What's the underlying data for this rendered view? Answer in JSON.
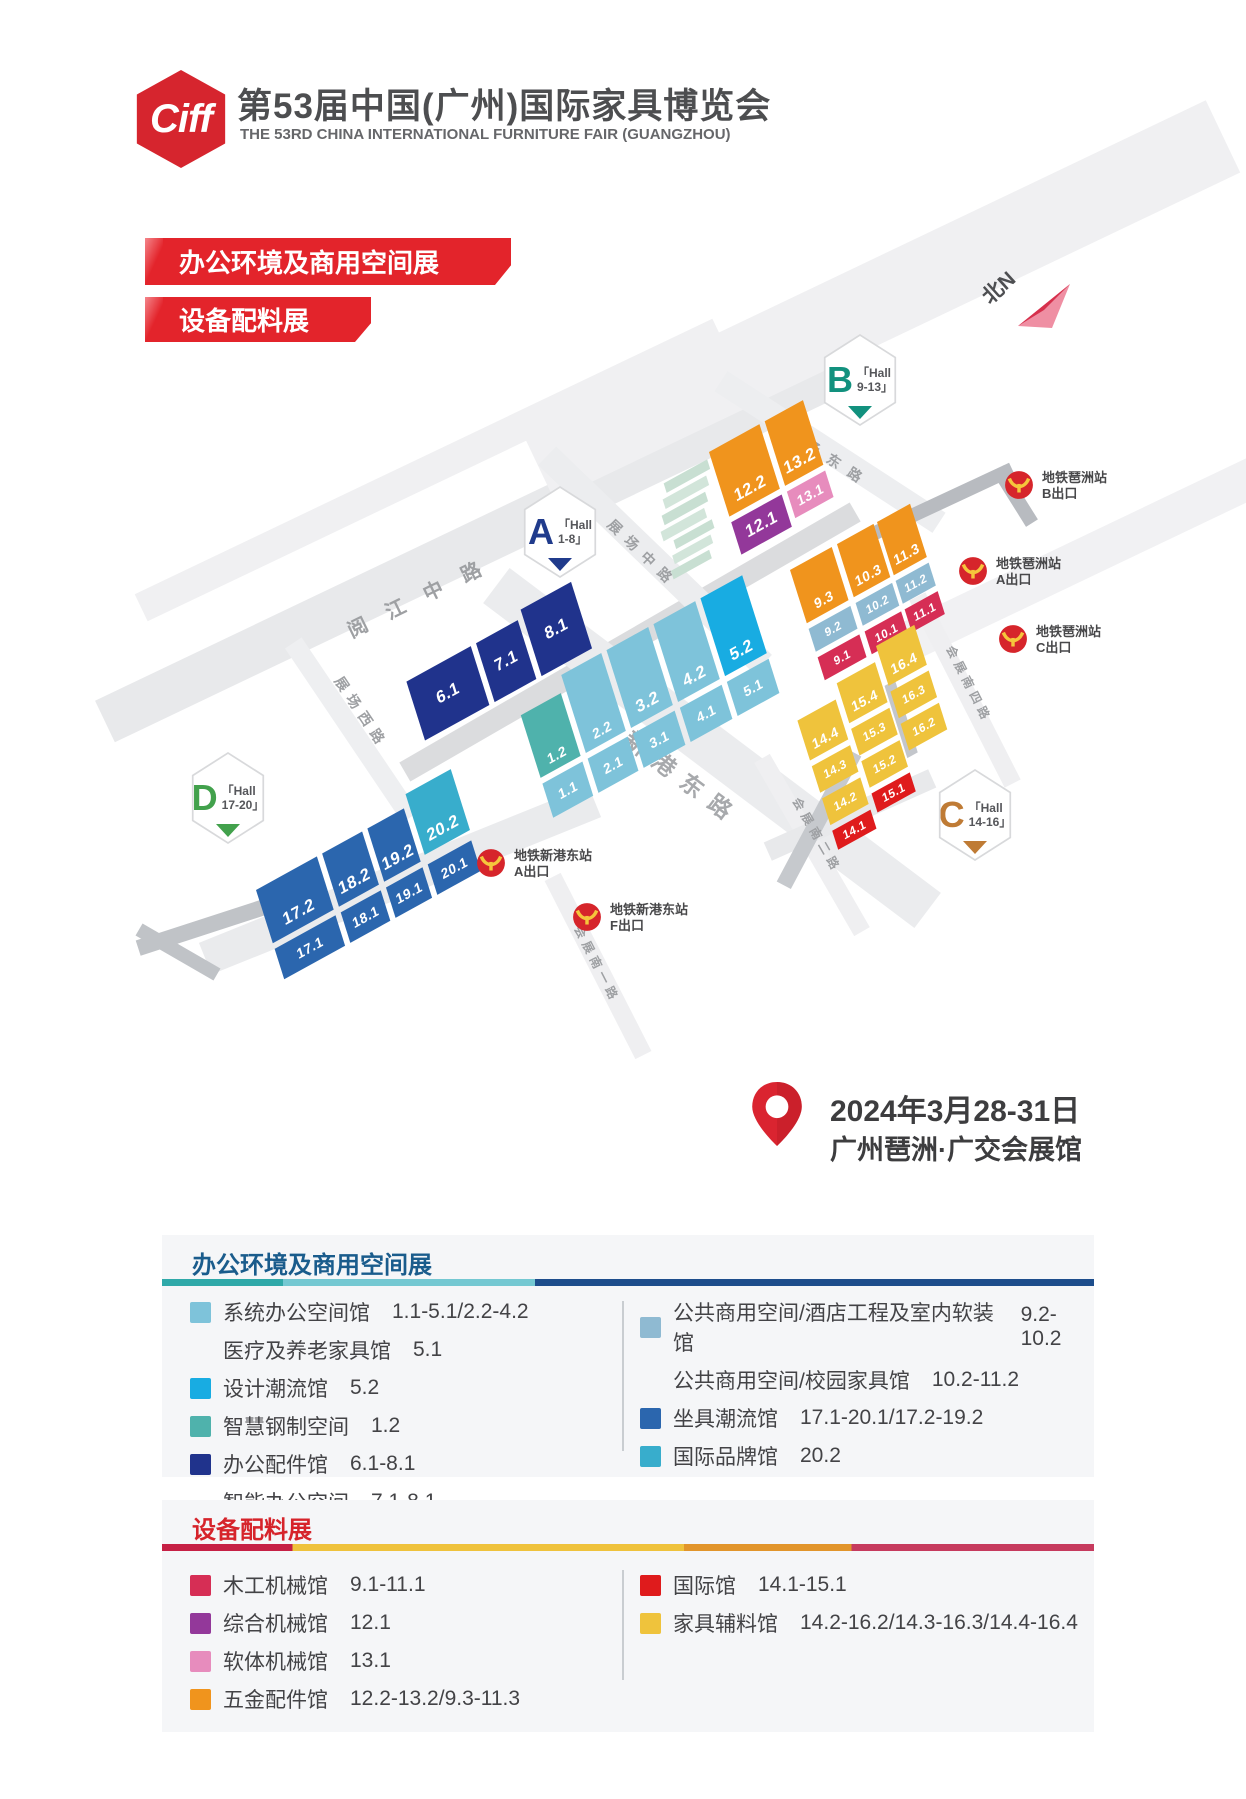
{
  "header": {
    "logo_text": "Ciff",
    "title": "第53届中国(广州)国际家具博览会",
    "subtitle": "THE 53RD CHINA INTERNATIONAL FURNITURE FAIR (GUANGZHOU)"
  },
  "banners": {
    "office": "办公环境及商用空间展",
    "equipment": "设备配料展"
  },
  "compass": {
    "label": "北N"
  },
  "map": {
    "halls": [
      {
        "letter": "A",
        "line1": "「Hall",
        "line2": "1-8」"
      },
      {
        "letter": "B",
        "line1": "「Hall",
        "line2": "9-13」"
      },
      {
        "letter": "C",
        "line1": "「Hall",
        "line2": "14-16」"
      },
      {
        "letter": "D",
        "line1": "「Hall",
        "line2": "17-20」"
      }
    ],
    "roads": {
      "yuejiang": "阅江中路",
      "zhanchang_xi": "展场西路",
      "zhanchang_zhong": "展场中路",
      "zhanchang_dong": "展场东路",
      "xingang": "新港东路",
      "huizhan_yi": "会展南一路",
      "huizhan_er": "会展南二路",
      "huizhan_si": "会展南四路"
    },
    "metro": [
      {
        "name": "地铁琶洲站",
        "exit": "B出口"
      },
      {
        "name": "地铁琶洲站",
        "exit": "A出口"
      },
      {
        "name": "地铁琶洲站",
        "exit": "C出口"
      },
      {
        "name": "地铁新港东站",
        "exit": "A出口"
      },
      {
        "name": "地铁新港东站",
        "exit": "F出口"
      }
    ],
    "blocks": {
      "v1_1": "1.1",
      "v1_2": "1.2",
      "v2_1": "2.1",
      "v2_2": "2.2",
      "v3_1": "3.1",
      "v3_2": "3.2",
      "v4_1": "4.1",
      "v4_2": "4.2",
      "v5_1": "5.1",
      "v5_2": "5.2",
      "v6_1": "6.1",
      "v7_1": "7.1",
      "v8_1": "8.1",
      "v9_1": "9.1",
      "v9_2": "9.2",
      "v9_3": "9.3",
      "v10_1": "10.1",
      "v10_2": "10.2",
      "v10_3": "10.3",
      "v11_1": "11.1",
      "v11_2": "11.2",
      "v11_3": "11.3",
      "v12_1": "12.1",
      "v12_2": "12.2",
      "v13_1": "13.1",
      "v13_2": "13.2",
      "v14_1": "14.1",
      "v14_2": "14.2",
      "v14_3": "14.3",
      "v14_4": "14.4",
      "v15_1": "15.1",
      "v15_2": "15.2",
      "v15_3": "15.3",
      "v15_4": "15.4",
      "v16_2": "16.2",
      "v16_3": "16.3",
      "v16_4": "16.4",
      "v17_1": "17.1",
      "v17_2": "17.2",
      "v18_1": "18.1",
      "v18_2": "18.2",
      "v19_1": "19.1",
      "v19_2": "19.2",
      "v20_1": "20.1",
      "v20_2": "20.2"
    }
  },
  "event": {
    "date": "2024年3月28-31日",
    "venue": "广州琶洲·广交会展馆"
  },
  "legend_office": {
    "title": "办公环境及商用空间展",
    "columns": [
      [
        {
          "color": "#7EC3DA",
          "label": "系统办公空间馆",
          "range": "1.1-5.1/2.2-4.2"
        },
        {
          "color": "",
          "label": "医疗及养老家具馆",
          "range": "5.1"
        },
        {
          "color": "#18ACE2",
          "label": "设计潮流馆",
          "range": "5.2"
        },
        {
          "color": "#4FB2AC",
          "label": "智慧钢制空间",
          "range": "1.2"
        },
        {
          "color": "#20338C",
          "label": "办公配件馆",
          "range": "6.1-8.1"
        },
        {
          "color": "",
          "label": "智能办公空间",
          "range": "7.1-8.1"
        }
      ],
      [
        {
          "color": "#8FBAD2",
          "label": "公共商用空间/酒店工程及室内软装馆",
          "range": "9.2-10.2"
        },
        {
          "color": "",
          "label": "公共商用空间/校园家具馆",
          "range": "10.2-11.2"
        },
        {
          "color": "#2B66AE",
          "label": "坐具潮流馆",
          "range": "17.1-20.1/17.2-19.2"
        },
        {
          "color": "#38ADCC",
          "label": "国际品牌馆",
          "range": "20.2"
        }
      ]
    ]
  },
  "legend_equipment": {
    "title": "设备配料展",
    "columns": [
      [
        {
          "color": "#D62E55",
          "label": "木工机械馆",
          "range": "9.1-11.1"
        },
        {
          "color": "#93389A",
          "label": "综合机械馆",
          "range": "12.1"
        },
        {
          "color": "#E78CBD",
          "label": "软体机械馆",
          "range": "13.1"
        },
        {
          "color": "#F0941D",
          "label": "五金配件馆",
          "range": "12.2-13.2/9.3-11.3"
        }
      ],
      [
        {
          "color": "#DF1B1C",
          "label": "国际馆",
          "range": "14.1-15.1"
        },
        {
          "color": "#EFC33C",
          "label": "家具辅料馆",
          "range": "14.2-16.2/14.3-16.3/14.4-16.4"
        }
      ]
    ]
  }
}
